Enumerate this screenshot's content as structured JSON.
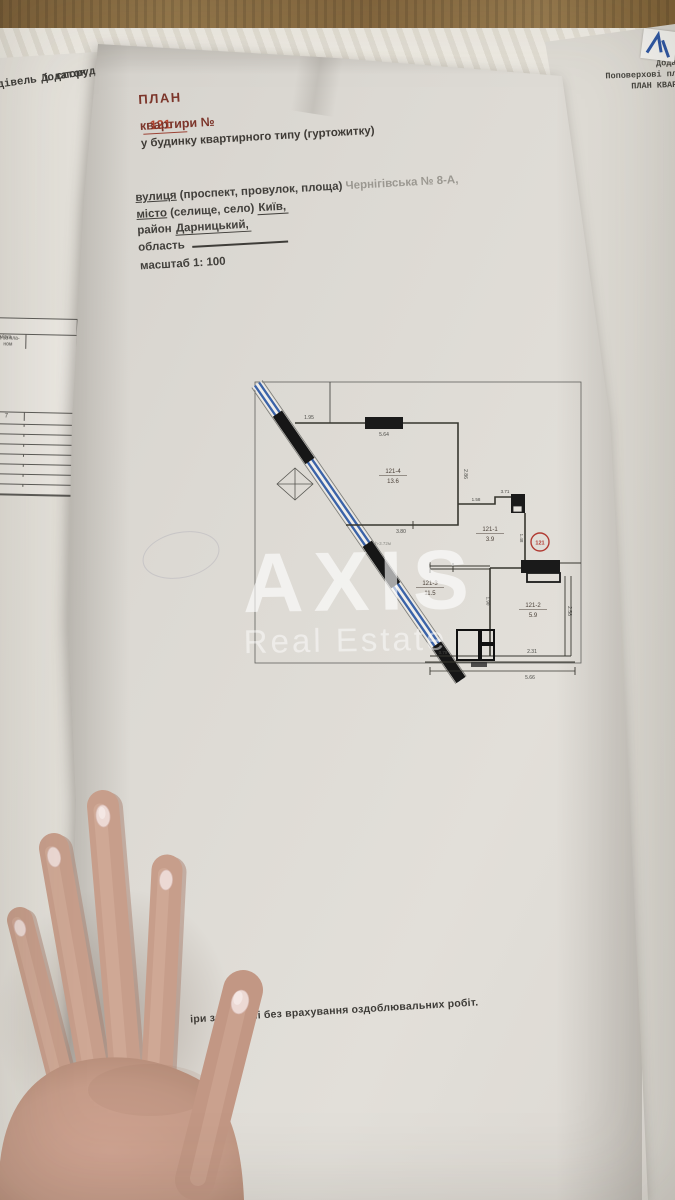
{
  "scene": {
    "back_left_sheet": {
      "corner_line1": "Додаток",
      "corner_line2": "дівель і споруд",
      "table": {
        "col_a_header": "№ за пла- ном",
        "col_b_header": "Примітка",
        "col_a_index": "7",
        "col_b_index": "8"
      }
    },
    "back_right_sheet": {
      "line1": "Додат",
      "line2": "Поповерхові пла",
      "line3": "ПЛАН КВАРТ"
    }
  },
  "document": {
    "title": "ПЛАН",
    "apt_line_label": "квартири №",
    "apt_number": "121",
    "subtitle": "у будинку квартирного типу (гуртожитку)",
    "street_word": "вулиця",
    "street_paren": "(проспект, провулок, площа)",
    "street_value": "Чернігівська № 8-А,",
    "city_word": "місто",
    "city_paren": "(селище, село)",
    "city_value": "Київ,",
    "district_word": "район",
    "district_value": "Дарницький,",
    "region_word": "область",
    "scale": "масштаб 1: 100",
    "footer_note": "іри зазначені без врахування оздоблювальних робіт."
  },
  "watermark": {
    "line1": "AXIS",
    "line2": "Real Estate"
  },
  "floorplan": {
    "badge": "121",
    "rooms": [
      {
        "id": "121-4",
        "area": "13.6"
      },
      {
        "id": "121-1",
        "area": "3.9"
      },
      {
        "id": "121-3",
        "area": "11.5"
      },
      {
        "id": "121-2",
        "area": "5.9"
      }
    ],
    "dims": {
      "d195": "1.95",
      "d564": "5.64",
      "d286": "2.86",
      "d380": "3.80",
      "h": "h-3.72м",
      "d158": "1.58",
      "d371": "3.71",
      "d148": "1.48",
      "d190": "1.90",
      "d231": "2.31",
      "d258": "2.58",
      "d079": "0.79",
      "d566": "5.66"
    },
    "colors": {
      "accent_red": "#b13c34",
      "glass_blue": "#3b63a8",
      "wall_black": "#1c1c1c"
    }
  }
}
